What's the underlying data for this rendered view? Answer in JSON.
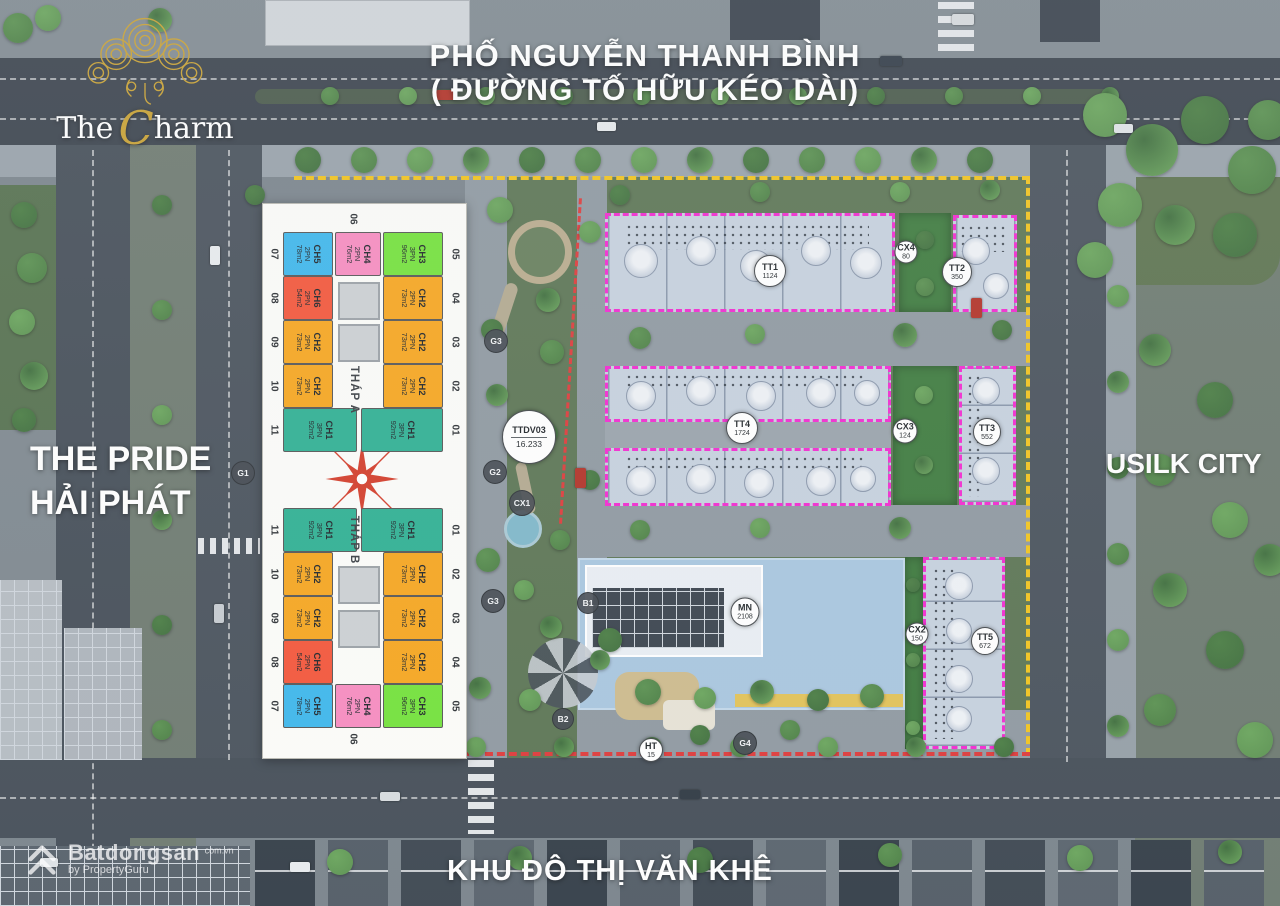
{
  "branding": {
    "the": "The",
    "c": "C",
    "harm": "harm"
  },
  "labels": {
    "top_line1": "PHỐ NGUYỄN THANH BÌNH",
    "top_line2": "( ĐƯỜNG TỐ HỮU KÉO DÀI)",
    "left_line1": "THE PRIDE",
    "left_line2": "HẢI PHÁT",
    "right_area": "USILK CITY",
    "bottom_area": "KHU ĐÔ THỊ VĂN KHÊ"
  },
  "compass": {
    "north": "B",
    "east": "Đ",
    "south": "N",
    "west": "T"
  },
  "unit_colors": {
    "CH1": "#2fb093",
    "CH2": "#f7a61f",
    "CH3": "#74e23b",
    "CH4": "#f78cc0",
    "CH5": "#3eb7ec",
    "CH6": "#f4563a"
  },
  "towers": {
    "tower_a": {
      "name": "THÁP A",
      "left": [
        {
          "no": "07",
          "code": "CH5",
          "beds": "2PN",
          "area": "78m2"
        },
        {
          "no": "08",
          "code": "CH6",
          "beds": "2PN",
          "area": "54m2"
        },
        {
          "no": "09",
          "code": "CH2",
          "beds": "2PN",
          "area": "73m2"
        },
        {
          "no": "10",
          "code": "CH2",
          "beds": "2PN",
          "area": "73m2"
        },
        {
          "no": "11",
          "code": "CH1",
          "beds": "3PN",
          "area": "92m2"
        }
      ],
      "right": [
        {
          "no": "05",
          "code": "CH3",
          "beds": "3PN",
          "area": "96m2"
        },
        {
          "no": "04",
          "code": "CH2",
          "beds": "2PN",
          "area": "73m2"
        },
        {
          "no": "03",
          "code": "CH2",
          "beds": "2PN",
          "area": "73m2"
        },
        {
          "no": "02",
          "code": "CH2",
          "beds": "2PN",
          "area": "73m2"
        },
        {
          "no": "01",
          "code": "CH1",
          "beds": "3PN",
          "area": "92m2"
        }
      ],
      "center": {
        "no": "06",
        "code": "CH4",
        "beds": "2PN",
        "area": "76m2"
      }
    },
    "tower_b": {
      "name": "THÁP B",
      "left": [
        {
          "no": "11",
          "code": "CH1",
          "beds": "3PN",
          "area": "92m2"
        },
        {
          "no": "10",
          "code": "CH2",
          "beds": "2PN",
          "area": "73m2"
        },
        {
          "no": "09",
          "code": "CH2",
          "beds": "2PN",
          "area": "73m2"
        },
        {
          "no": "08",
          "code": "CH6",
          "beds": "2PN",
          "area": "54m2"
        },
        {
          "no": "07",
          "code": "CH5",
          "beds": "2PN",
          "area": "78m2"
        }
      ],
      "right": [
        {
          "no": "01",
          "code": "CH1",
          "beds": "3PN",
          "area": "92m2"
        },
        {
          "no": "02",
          "code": "CH2",
          "beds": "2PN",
          "area": "73m2"
        },
        {
          "no": "03",
          "code": "CH2",
          "beds": "2PN",
          "area": "73m2"
        },
        {
          "no": "04",
          "code": "CH2",
          "beds": "2PN",
          "area": "73m2"
        },
        {
          "no": "05",
          "code": "CH3",
          "beds": "3PN",
          "area": "96m2"
        }
      ],
      "center": {
        "no": "06",
        "code": "CH4",
        "beds": "2PN",
        "area": "76m2"
      }
    }
  },
  "site_badges": [
    {
      "id": "TT1",
      "label": "TT1",
      "value": "1124"
    },
    {
      "id": "TT2",
      "label": "TT2",
      "value": "350"
    },
    {
      "id": "TT3",
      "label": "TT3",
      "value": "552"
    },
    {
      "id": "TT4",
      "label": "TT4",
      "value": "1724"
    },
    {
      "id": "TT5",
      "label": "TT5",
      "value": "672"
    },
    {
      "id": "CX2",
      "label": "CX2",
      "value": "150"
    },
    {
      "id": "CX3",
      "label": "CX3",
      "value": "124"
    },
    {
      "id": "CX4",
      "label": "CX4",
      "value": "80"
    },
    {
      "id": "MN",
      "label": "MN",
      "value": "2108"
    },
    {
      "id": "HT",
      "label": "HT",
      "value": "15"
    },
    {
      "id": "TTDV03",
      "label": "TTDV03",
      "value": "16.233"
    }
  ],
  "road_markers": [
    {
      "id": "G1",
      "label": "G1"
    },
    {
      "id": "G2",
      "label": "G2"
    },
    {
      "id": "G3A",
      "label": "G3"
    },
    {
      "id": "G3B",
      "label": "G3"
    },
    {
      "id": "G4",
      "label": "G4"
    },
    {
      "id": "B1",
      "label": "B1"
    },
    {
      "id": "B2",
      "label": "B2"
    },
    {
      "id": "CX1",
      "label": "CX1"
    }
  ],
  "watermark": {
    "name": "Batdongsan",
    "domain": "com.vn",
    "byline": "by PropertyGuru"
  }
}
